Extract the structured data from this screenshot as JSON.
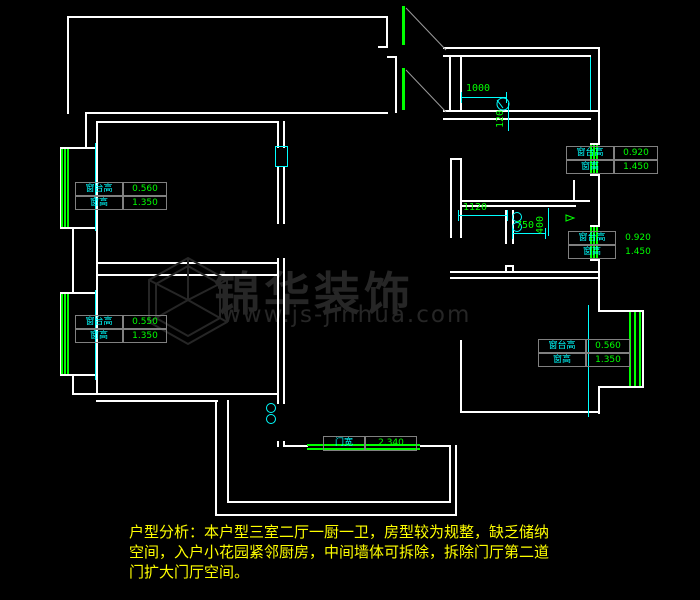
{
  "app": {
    "type": "cad-floorplan-view"
  },
  "colors": {
    "background": "#000000",
    "wall": "#ffffff",
    "window": "#00ff00",
    "dimension_line": "#00ffff",
    "dimension_text": "#00ff00",
    "table_label": "#00ffff",
    "table_value": "#00ff00",
    "table_border": "#808080",
    "analysis_text": "#ffff00",
    "watermark": "#262626"
  },
  "win_tables": {
    "upper_left": {
      "l1": "窗台高",
      "v1": "0.560",
      "l2": "窗高",
      "v2": "1.350"
    },
    "lower_left": {
      "l1": "窗台高",
      "v1": "0.550",
      "l2": "窗高",
      "v2": "1.350"
    },
    "upper_right": {
      "l1": "窗台高",
      "v1": "0.920",
      "l2": "窗高",
      "v2": "1.450"
    },
    "mid_right": {
      "l1": "窗台高",
      "v1": "0.920",
      "l2": "窗高",
      "v2": "1.450"
    },
    "lower_right": {
      "l1": "窗台高",
      "v1": "0.560",
      "l2": "窗高",
      "v2": "1.350"
    }
  },
  "door_table": {
    "label": "门宽",
    "value": "2.340"
  },
  "dimensions": {
    "entry_width": "1000",
    "entry_depth": "120",
    "kitchen_opening": "1120",
    "bath_door": "750",
    "bath_side": "400"
  },
  "watermark": {
    "name": "锦华装饰",
    "site": "www.js-jinhua.com"
  },
  "analysis": {
    "line1": "户型分析：本户型三室二厅一厨一卫，房型较为规整，缺乏储纳",
    "line2": "空间，入户小花园紧邻厨房，中间墙体可拆除，拆除门厅第二道",
    "line3": "门扩大门厅空间。"
  }
}
